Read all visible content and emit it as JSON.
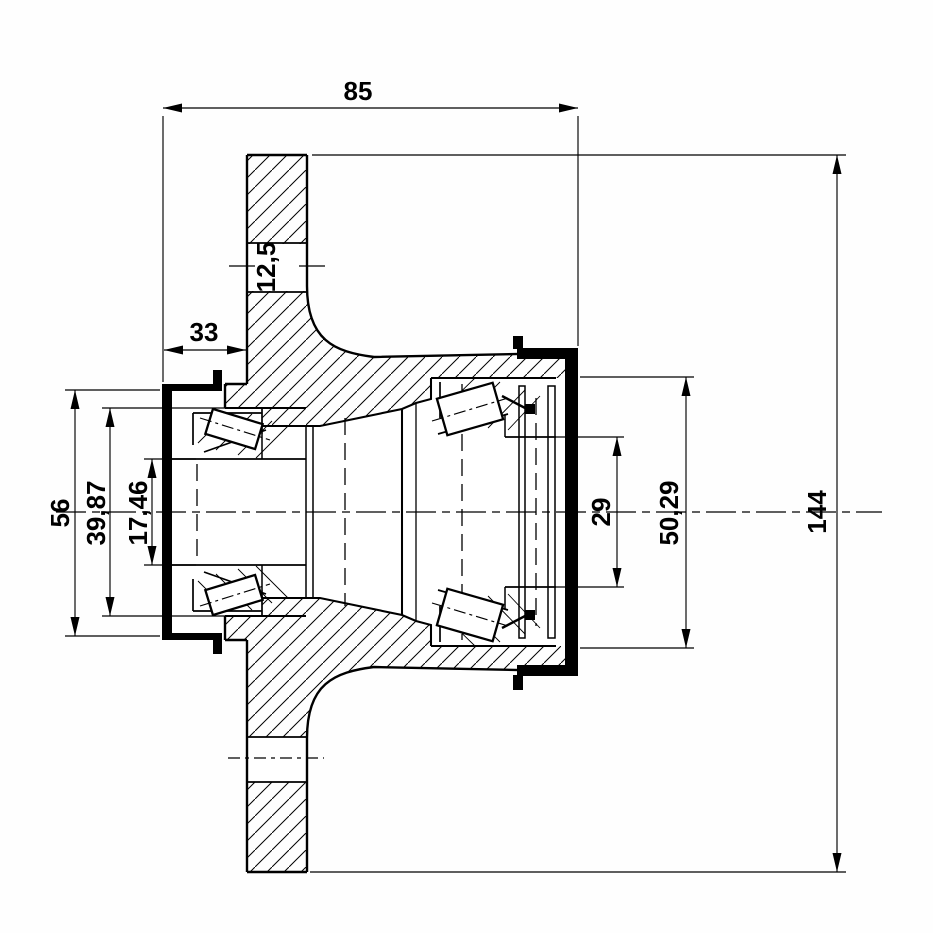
{
  "drawing": {
    "background": "#fefefe",
    "ink": "#000000",
    "dimensions": {
      "top_width": "85",
      "flange_hole": "12,5",
      "seal_offset": "33",
      "seal_outer": "56",
      "left_bearing_outer": "39,87",
      "left_bore": "17,46",
      "right_bore": "29",
      "right_bearing_outer": "50,29",
      "flange_diameter": "144"
    }
  }
}
